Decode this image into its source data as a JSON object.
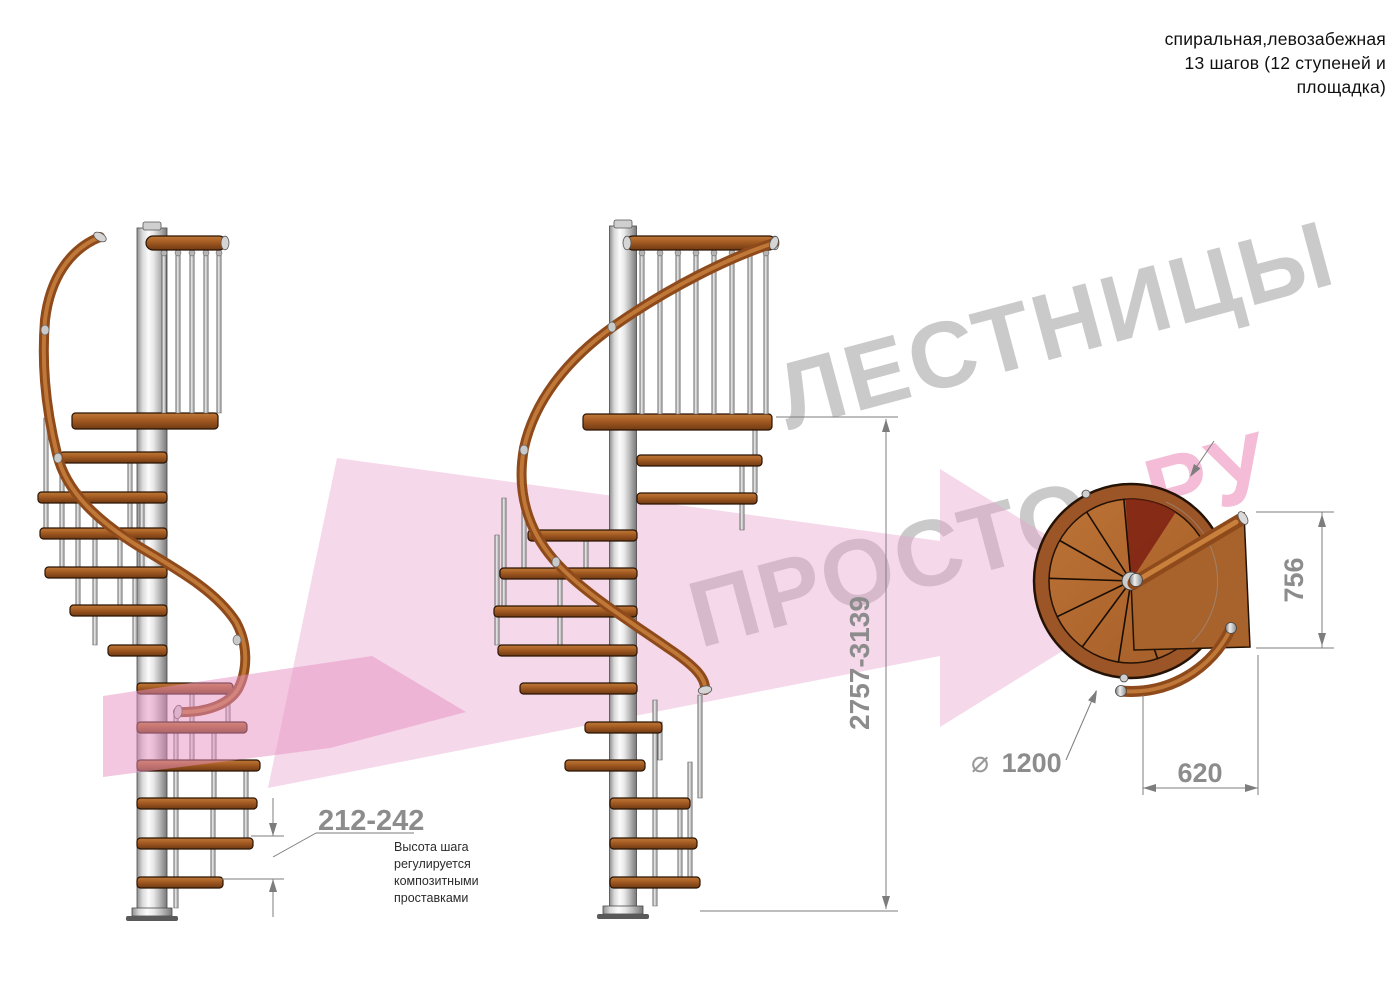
{
  "title": {
    "line1": "спиральная,левозабежная",
    "line2": "13 шагов (12 ступеней и",
    "line3": "площадка)"
  },
  "watermark": {
    "top_text": "ЛЕСТНИЦЫ",
    "gray_part": "ПРОСТО",
    "pink_part": ".РУ",
    "gray_color": "#cacaca",
    "pink_color": "#f4bcd6",
    "arrow_pale_color": "#e8a3cc",
    "arrow_bright_color": "#e890c2"
  },
  "dimensions": {
    "step_height": {
      "value": "212-242",
      "note_lines": [
        "Высота шага",
        "регулируется",
        "композитными",
        "проставками"
      ]
    },
    "total_height": {
      "value": "2757-3139"
    },
    "landing_depth": {
      "value": "756"
    },
    "tread_width": {
      "value": "620"
    },
    "diameter": {
      "symbol": "⌀",
      "value": "1200"
    }
  },
  "colors": {
    "wood_mid": "#a35a22",
    "wood_dark": "#6f3a12",
    "wood_light": "#c07a38",
    "metal_light": "#fbfbfb",
    "metal_dark": "#787878",
    "dimension_line": "#7d7d7d",
    "dimension_text": "#8c8c8c",
    "annotation_text": "#2b2b2b"
  }
}
